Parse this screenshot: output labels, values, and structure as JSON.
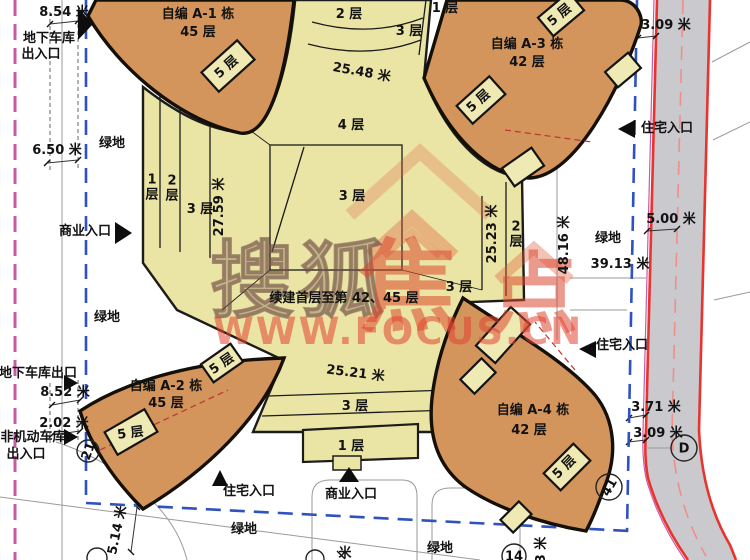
{
  "watermark": {
    "brand_left": "搜狐",
    "brand_right_1": "焦",
    "brand_right_2": "点",
    "site_url": "WWW.FOCUS.CN"
  },
  "towers": [
    {
      "id": "A-1",
      "name": "自编 A-1 栋",
      "floors": "45 层"
    },
    {
      "id": "A-2",
      "name": "自编 A-2 栋",
      "floors": "45 层"
    },
    {
      "id": "A-3",
      "name": "自编 A-3 栋",
      "floors": "42 层"
    },
    {
      "id": "A-4",
      "name": "自编 A-4 栋",
      "floors": "42 层"
    }
  ],
  "colors": {
    "tower_orange": "#d3955c",
    "podium_yellow": "#ebe5a5",
    "road_gray": "#c9c9ce",
    "road_red": "#e8332e",
    "boundary_blue": "#2f52be",
    "magenta_line": "#c85aa5"
  },
  "plan": {
    "labels": [
      {
        "name": "dim-8-54",
        "text": "8.54 米",
        "x": 64,
        "y": 16
      },
      {
        "name": "entrance-garage-inout-1",
        "text": "地下车库",
        "x": 49,
        "y": 42,
        "size": 14
      },
      {
        "name": "entrance-garage-inout-2",
        "text": "出入口",
        "x": 41,
        "y": 58,
        "size": 14
      },
      {
        "name": "tower-a1-name",
        "text": "自编 A-1 栋",
        "x": 198,
        "y": 18,
        "size": 15
      },
      {
        "name": "tower-a1-floors",
        "text": "45 层",
        "x": 198,
        "y": 36,
        "size": 15
      },
      {
        "name": "block-a1-5f",
        "text": "5 层",
        "x": 229,
        "y": 70,
        "rot": -42
      },
      {
        "name": "green-area-1",
        "text": "绿地",
        "x": 112,
        "y": 147
      },
      {
        "name": "dim-6-50",
        "text": "6.50 米",
        "x": 57,
        "y": 154
      },
      {
        "name": "band-2f-top",
        "text": "2 层",
        "x": 349,
        "y": 18
      },
      {
        "name": "band-3f-top",
        "text": "3 层",
        "x": 409,
        "y": 35
      },
      {
        "name": "band-1f-top",
        "text": "1 层",
        "x": 445,
        "y": 12
      },
      {
        "name": "dim-25-48",
        "text": "25.48 米",
        "x": 361,
        "y": 76,
        "rot": 10,
        "size": 14
      },
      {
        "name": "band-4f",
        "text": "4 层",
        "x": 351,
        "y": 129
      },
      {
        "name": "core-3f",
        "text": "3 层",
        "x": 352,
        "y": 200
      },
      {
        "name": "tower-a3-name",
        "text": "自编 A-3 栋",
        "x": 527,
        "y": 48,
        "size": 15
      },
      {
        "name": "tower-a3-floors",
        "text": "42 层",
        "x": 527,
        "y": 66,
        "size": 15
      },
      {
        "name": "block-a3-5f-top",
        "text": "5 层",
        "x": 562,
        "y": 18,
        "rot": -40
      },
      {
        "name": "block-a3-5f-left",
        "text": "5 层",
        "x": 481,
        "y": 104,
        "rot": -42
      },
      {
        "name": "dim-3-09-top",
        "text": "3.09 米",
        "x": 666,
        "y": 29
      },
      {
        "name": "entrance-res-1",
        "text": "住宅入口",
        "x": 667,
        "y": 132,
        "size": 14
      },
      {
        "name": "band-1f-left",
        "text": "1 层",
        "x": 152,
        "y": 191,
        "stack": true
      },
      {
        "name": "band-2f-left",
        "text": "2 层",
        "x": 172,
        "y": 192,
        "stack": true
      },
      {
        "name": "band-3f-left",
        "text": "3 层",
        "x": 200,
        "y": 213
      },
      {
        "name": "dim-27-59",
        "text": "27.59 米",
        "x": 223,
        "y": 207,
        "rot": -90
      },
      {
        "name": "entrance-comm-1",
        "text": "商业入口",
        "x": 85,
        "y": 235,
        "size": 14
      },
      {
        "name": "green-area-2",
        "text": "绿地",
        "x": 107,
        "y": 321
      },
      {
        "name": "note-construction",
        "text": "续建首层至第 42、45 层",
        "x": 344,
        "y": 302,
        "size": 13
      },
      {
        "name": "dim-25-23",
        "text": "25.23 米",
        "x": 496,
        "y": 234,
        "rot": -90
      },
      {
        "name": "band-2f-right",
        "text": "2 层",
        "x": 516,
        "y": 238,
        "stack": true
      },
      {
        "name": "band-3f-right",
        "text": "3 层",
        "x": 459,
        "y": 291
      },
      {
        "name": "dim-48-16",
        "text": "48.16 米",
        "x": 568,
        "y": 245,
        "rot": -90
      },
      {
        "name": "green-area-3",
        "text": "绿地",
        "x": 608,
        "y": 242
      },
      {
        "name": "dim-39-13",
        "text": "39.13 米",
        "x": 620,
        "y": 268
      },
      {
        "name": "dim-5-00",
        "text": "5.00 米",
        "x": 671,
        "y": 223
      },
      {
        "name": "entrance-res-2",
        "text": "住宅入口",
        "x": 622,
        "y": 349,
        "size": 14
      },
      {
        "name": "entrance-garage-out",
        "text": "地下车库出口",
        "x": 38,
        "y": 377,
        "size": 13
      },
      {
        "name": "dim-8-52",
        "text": "8.52 米",
        "x": 65,
        "y": 396
      },
      {
        "name": "dim-2-02",
        "text": "2.02 米",
        "x": 64,
        "y": 427
      },
      {
        "name": "entrance-nonmotor-1",
        "text": "非机动车库",
        "x": 33,
        "y": 441,
        "size": 14
      },
      {
        "name": "entrance-nonmotor-2",
        "text": "出入口",
        "x": 26,
        "y": 458,
        "size": 14
      },
      {
        "name": "tower-a2-name",
        "text": "自编 A-2 栋",
        "x": 166,
        "y": 390,
        "size": 15
      },
      {
        "name": "tower-a2-floors",
        "text": "45 层",
        "x": 166,
        "y": 407,
        "size": 15
      },
      {
        "name": "block-a2-5f",
        "text": "5 层",
        "x": 131,
        "y": 437,
        "rot": -8
      },
      {
        "name": "block-a2-5f-tip",
        "text": "5 层",
        "x": 224,
        "y": 367,
        "rot": -35,
        "size": 12
      },
      {
        "name": "dim-25-21",
        "text": "25.21 米",
        "x": 355,
        "y": 377,
        "rot": 7,
        "size": 14
      },
      {
        "name": "band-3f-bottom",
        "text": "3 层",
        "x": 355,
        "y": 410
      },
      {
        "name": "band-1f-bottom",
        "text": "1 层",
        "x": 351,
        "y": 450
      },
      {
        "name": "entrance-res-3",
        "text": "住宅入口",
        "x": 249,
        "y": 495,
        "size": 14
      },
      {
        "name": "entrance-comm-2",
        "text": "商业入口",
        "x": 351,
        "y": 498,
        "size": 14
      },
      {
        "name": "green-area-4",
        "text": "绿地",
        "x": 244,
        "y": 533
      },
      {
        "name": "green-area-5",
        "text": "绿地",
        "x": 440,
        "y": 552
      },
      {
        "name": "tower-a4-name",
        "text": "自编 A-4 栋",
        "x": 533,
        "y": 414,
        "size": 15
      },
      {
        "name": "tower-a4-floors",
        "text": "42 层",
        "x": 529,
        "y": 434,
        "size": 15
      },
      {
        "name": "block-a4-5f",
        "text": "5 层",
        "x": 567,
        "y": 470,
        "rot": -45
      },
      {
        "name": "dim-3-71",
        "text": "3.71 米",
        "x": 656,
        "y": 411
      },
      {
        "name": "dim-3-09-bottom",
        "text": "3.09 米",
        "x": 658,
        "y": 437
      },
      {
        "name": "dim-5-14",
        "text": "5.14 米",
        "x": 121,
        "y": 531,
        "rot": -78
      },
      {
        "name": "dim-partial-right",
        "text": "3 米",
        "x": 545,
        "y": 550,
        "rot": -90
      },
      {
        "name": "dim-partial-center",
        "text": "米",
        "x": 345,
        "y": 557
      }
    ],
    "bubbles": [
      {
        "name": "axis-bubble-d",
        "text": "D",
        "x": 684,
        "y": 448,
        "r": 13
      },
      {
        "name": "axis-bubble-41",
        "text": "41",
        "x": 609,
        "y": 487,
        "r": 13,
        "rot": -60
      },
      {
        "name": "axis-bubble-21",
        "text": "21",
        "x": 88,
        "y": 451,
        "r": 11,
        "rot": -70
      },
      {
        "name": "axis-bubble-14",
        "text": "14",
        "x": 514,
        "y": 556,
        "r": 12
      },
      {
        "name": "axis-bubble-partial-1",
        "text": "",
        "x": 97,
        "y": 558,
        "r": 10
      },
      {
        "name": "axis-bubble-partial-2",
        "text": "",
        "x": 315,
        "y": 559,
        "r": 9
      }
    ]
  }
}
